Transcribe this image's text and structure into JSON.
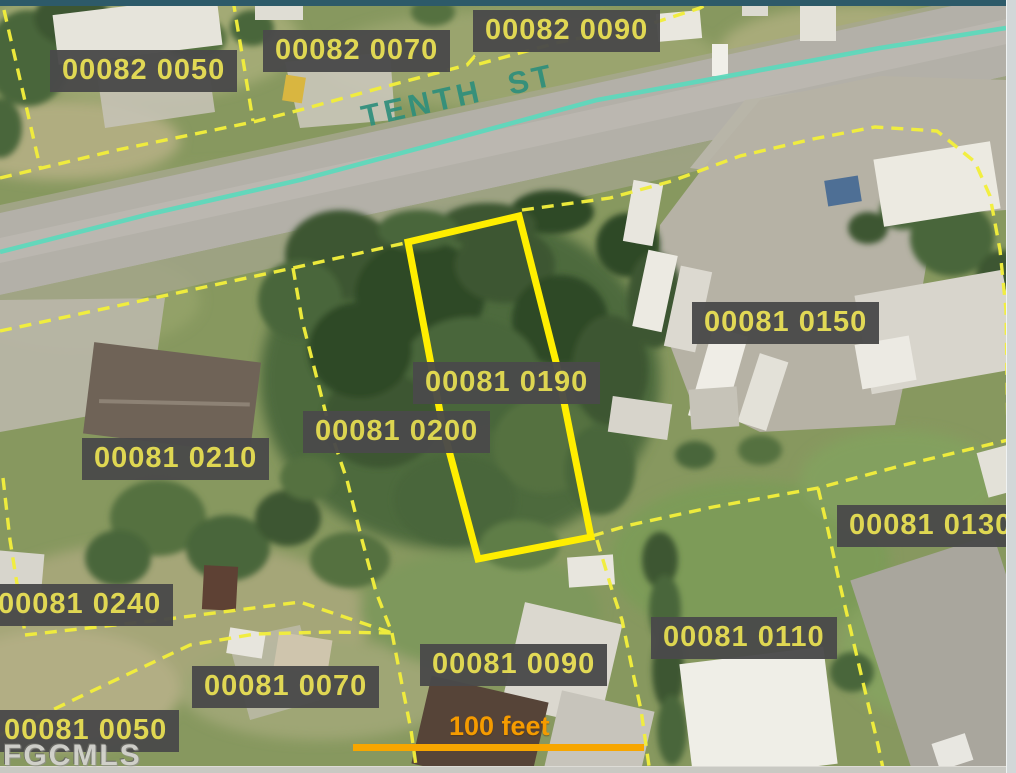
{
  "window": {
    "top_edge_color": "#2d5a69",
    "right_strip_color": "#d2d7d8",
    "bottom_strip_color": "#c9c9c3"
  },
  "map": {
    "street_name": "TENTH ST",
    "watermark": "FGCMLS",
    "scale_bar_label": "100 feet",
    "selected_parcel_id": "00081 0190",
    "colors": {
      "parcel_line": "#f2ee3c",
      "selected_outline": "#ffee00",
      "label_background": "#4a4a4a",
      "label_text": "#e3da52",
      "street_centerline": "#5ed8bc",
      "street_name_text": "#2f8f7c",
      "scale_bar": "#f7a600",
      "scale_text": "#f59b00"
    },
    "parcel_labels": [
      {
        "id": "00082 0050",
        "x": 50,
        "y": 50,
        "selected": false
      },
      {
        "id": "00082 0070",
        "x": 263,
        "y": 30,
        "selected": false
      },
      {
        "id": "00082 0090",
        "x": 473,
        "y": 10,
        "selected": false
      },
      {
        "id": "00081 0150",
        "x": 692,
        "y": 302,
        "selected": false
      },
      {
        "id": "00081 0190",
        "x": 413,
        "y": 362,
        "selected": true
      },
      {
        "id": "00081 0200",
        "x": 303,
        "y": 411,
        "selected": false
      },
      {
        "id": "00081 0210",
        "x": 82,
        "y": 438,
        "selected": false
      },
      {
        "id": "00081 0240",
        "x": -14,
        "y": 584,
        "selected": false
      },
      {
        "id": "00081 0130",
        "x": 837,
        "y": 505,
        "selected": false
      },
      {
        "id": "00081 0110",
        "x": 651,
        "y": 617,
        "selected": false
      },
      {
        "id": "00081 0090",
        "x": 420,
        "y": 644,
        "selected": false
      },
      {
        "id": "00081 0070",
        "x": 192,
        "y": 666,
        "selected": false
      },
      {
        "id": "00081 0050",
        "x": -8,
        "y": 710,
        "selected": false
      }
    ]
  }
}
